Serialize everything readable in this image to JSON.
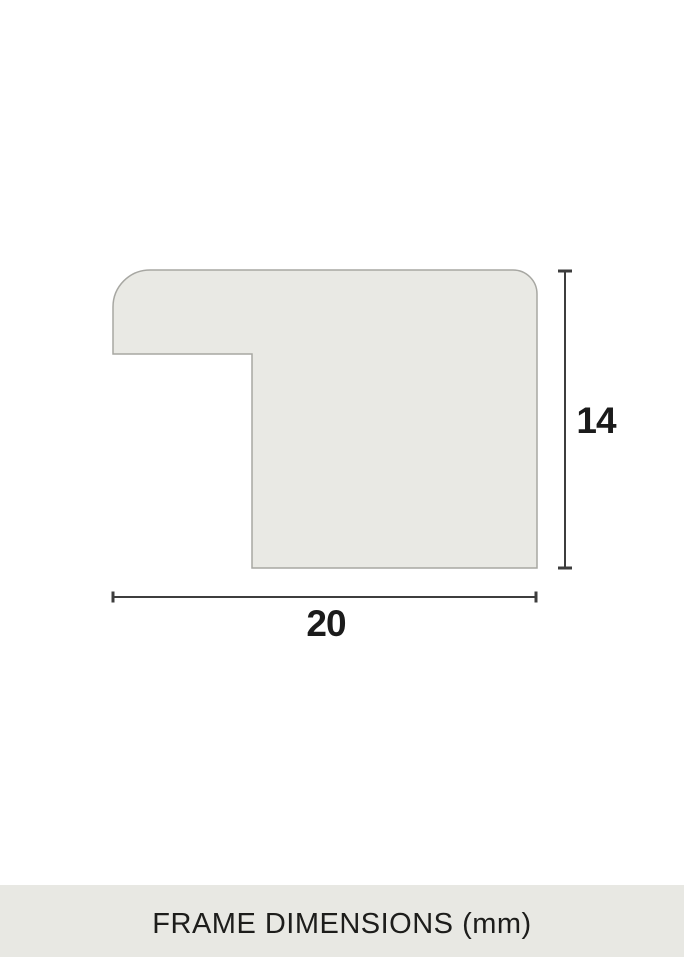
{
  "diagram": {
    "type": "frame-profile-cross-section",
    "labels": {
      "height": "14",
      "width": "20"
    },
    "colors": {
      "background": "#ffffff",
      "shape_fill": "#e9e9e4",
      "shape_stroke": "#a7a7a2",
      "dimension_line": "#3d3d3d",
      "label_text": "#1b1b1b"
    }
  },
  "caption": {
    "text": "FRAME DIMENSIONS (mm)",
    "background": "#e8e8e3",
    "text_color": "#1d1d1b"
  }
}
